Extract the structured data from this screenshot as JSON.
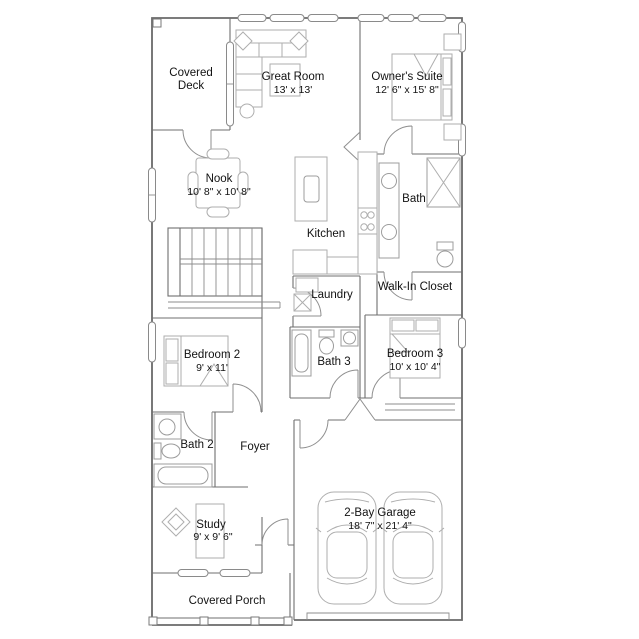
{
  "document": {
    "type": "floor-plan",
    "floors": "main level",
    "background": "#ffffff"
  },
  "colors": {
    "wall": "#6a6a6a",
    "furniture": "#aeaeae",
    "text": "#121212",
    "background": "#ffffff"
  },
  "rooms": {
    "covered_deck": {
      "name": "Covered Deck",
      "line1": "Covered",
      "line2": "Deck"
    },
    "great_room": {
      "name": "Great Room",
      "dims": "13' x 13'"
    },
    "owners_suite": {
      "name": "Owner's Suite",
      "dims": "12' 6\" x 15' 8\""
    },
    "nook": {
      "name": "Nook",
      "dims": "10' 8\" x 10' 8\""
    },
    "kitchen": {
      "name": "Kitchen"
    },
    "bath": {
      "name": "Bath"
    },
    "walk_in_closet": {
      "name": "Walk-In Closet"
    },
    "laundry": {
      "name": "Laundry"
    },
    "bedroom_2": {
      "name": "Bedroom 2",
      "dims": "9' x 11'"
    },
    "bath_3": {
      "name": "Bath 3"
    },
    "bedroom_3": {
      "name": "Bedroom 3",
      "dims": "10' x 10' 4\""
    },
    "bath_2": {
      "name": "Bath 2"
    },
    "foyer": {
      "name": "Foyer"
    },
    "study": {
      "name": "Study",
      "dims": "9' x 9' 6\""
    },
    "garage": {
      "name": "2-Bay Garage",
      "dims": "18' 7\" x 21' 4\""
    },
    "covered_porch": {
      "name": "Covered Porch"
    }
  }
}
